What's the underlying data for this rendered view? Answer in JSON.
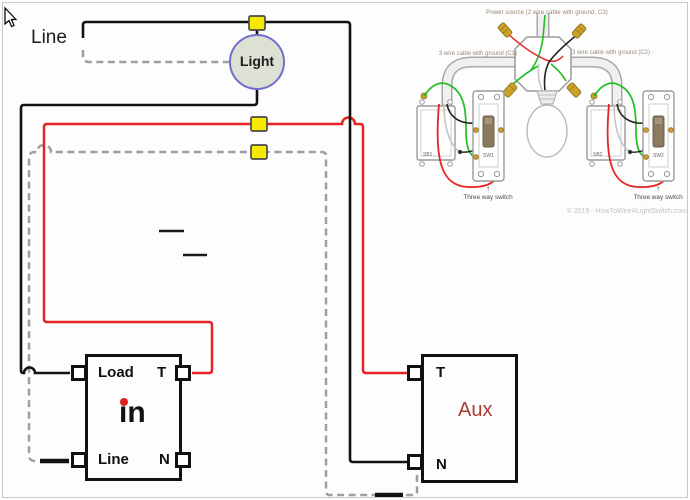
{
  "labels": {
    "line_feed": "Line",
    "light": "Light"
  },
  "load_module": {
    "load_terminal": "Load",
    "t_terminal": "T",
    "line_terminal": "Line",
    "n_terminal": "N",
    "logo": "in"
  },
  "aux_module": {
    "t_terminal": "T",
    "n_terminal": "N",
    "name": "Aux"
  },
  "inset": {
    "power_label": "Power source (2 wire cable with ground, C3)",
    "cable_c1_label": "3 wire cable with ground (C1)",
    "cable_c2_label": "3 wire cable with ground (C2)",
    "sb1_label": "SB1",
    "sw1_label": "SW1",
    "sb2_label": "SB2",
    "sw2_label": "SW2",
    "three_way_left": "Three way switch",
    "three_way_right": "Three way switch",
    "arrow_up_left": "↑",
    "arrow_up_right": "↑",
    "copyright": "© 2019 - HowToWireALightSwitch.com"
  },
  "colors": {
    "hot_wire": "#121212",
    "traveler_wire": "#e62222",
    "neutral_wire": "#9e9e9e",
    "wire_connector": "#f6e900",
    "light_fill": "#dce1d3",
    "light_stroke": "#6f6fd0",
    "aux_text": "#ad3c32",
    "logo_dot": "#e02020",
    "inset_ground_wire": "#1fbf1f",
    "inset_brass": "#c9a227"
  }
}
